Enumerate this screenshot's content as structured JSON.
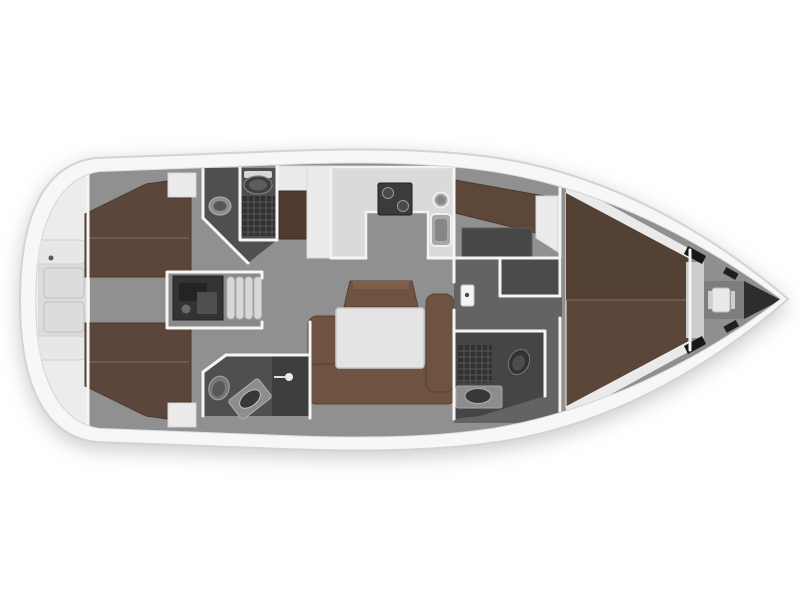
{
  "diagram": {
    "kind": "sailing-yacht-interior-floorplan",
    "orientation": "bow-right"
  },
  "colors": {
    "background": "#ffffff",
    "hull_fill": "#f7f7f7",
    "hull_stroke": "#d3d3d3",
    "deck_line": "#dddddd",
    "floor": "#909090",
    "floor_aft": "#8a8a8a",
    "corridor": "#636363",
    "closet": "#4b4b4b",
    "stern_platform": "#ececec",
    "stern_seat": "#e7e7e7",
    "stern_panel": "#dcdcdc",
    "berth": "#5a463a",
    "berth_seam": "#7a6557",
    "door_wood": "#503c2f",
    "settee": "#6e5342",
    "settee_top": "#7d5f4a",
    "table": "#e4e4e4",
    "counter": "#dadada",
    "cabinet": "#ebebeb",
    "wall": "#f5f5f5",
    "head_floor": "#4f4f4f",
    "head_floor_fwd": "#454545",
    "shower_stall": "#3e3e3e",
    "grate": "#313131",
    "grate_line": "#585858",
    "toilet_dark": "#3f3f3f",
    "toilet_rim": "#787878",
    "toilet_light": "#c9c9c9",
    "fixture_mid": "#8d8d8d",
    "basin_dark": "#383838",
    "engine": "#333333",
    "engine_part": "#4f4f4f",
    "steps": "#d8d8d8",
    "stove": "#3b3b3b",
    "burner": "#9a9a9a",
    "sink": "#a8a8a8",
    "sink_inner": "#868686",
    "nav_seat": "#5c4738",
    "chart_table": "#474747",
    "v_shelf": "#eaeaea",
    "berth_fwd": "#5b4739",
    "berth_fwd_dark": "#534135",
    "bow_deck": "#8f8f8f",
    "bow_post": "#171717",
    "bow_gap": "#cccccc",
    "windlass": "#e9e9e9",
    "windlass_base": "#7d7d7d",
    "bow_tip": "#2d2d2d",
    "latch": "#5a5a5a",
    "hatch": "#fafafa"
  }
}
